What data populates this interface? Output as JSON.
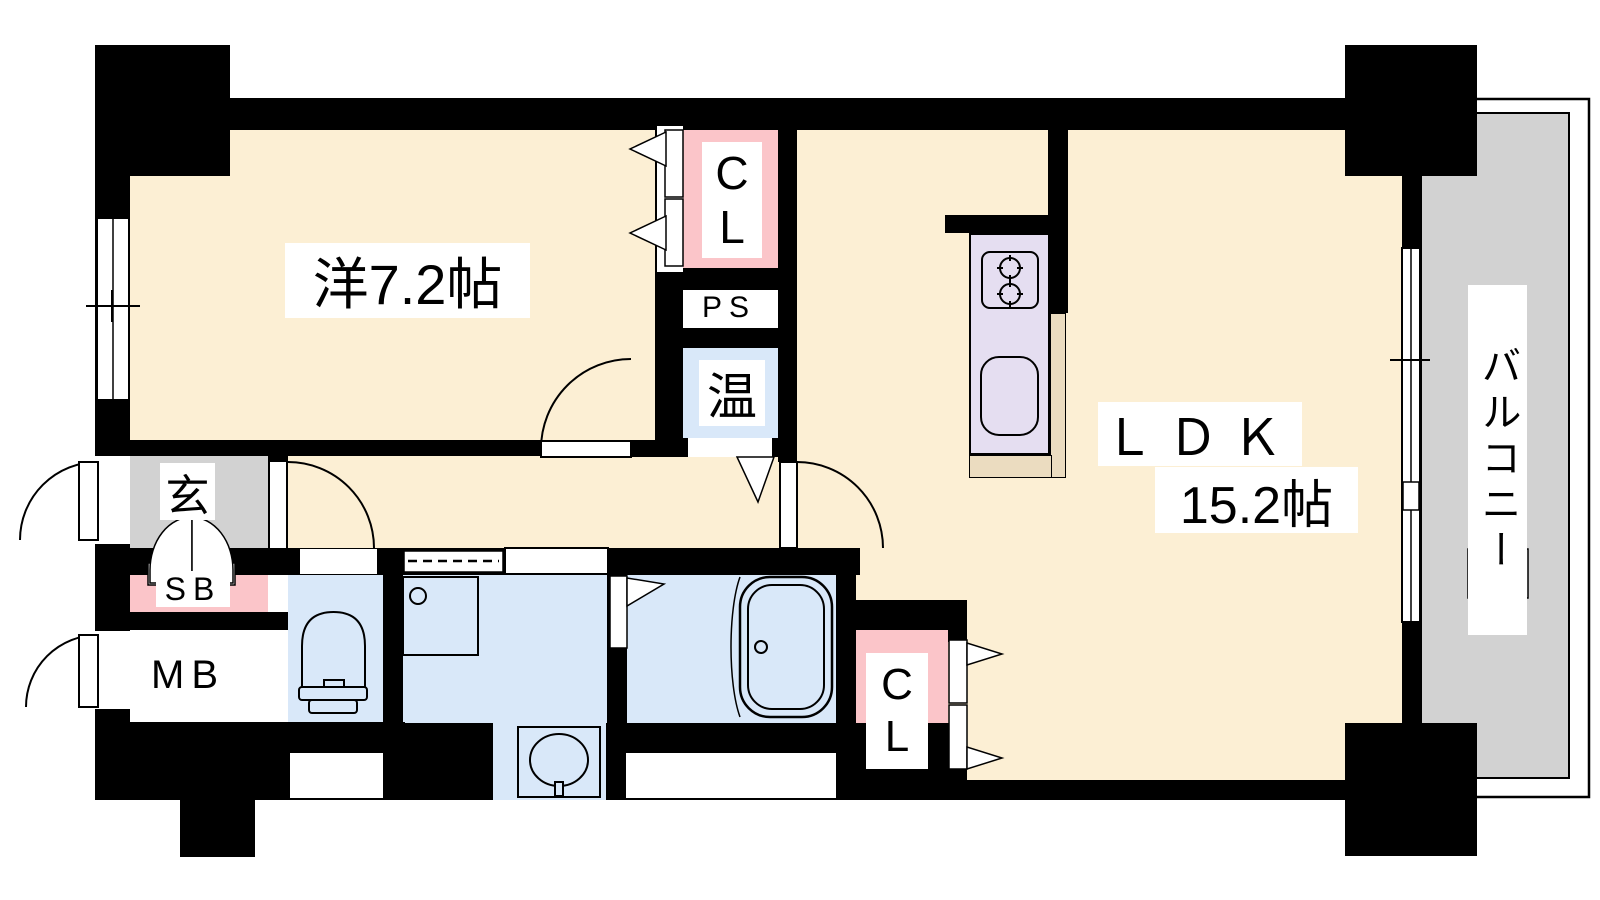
{
  "plan": {
    "western_room": {
      "label": "洋7.2帖"
    },
    "ldk": {
      "name": "ＬＤＫ",
      "size": "15.2帖"
    },
    "balcony": {
      "label": "バルコニー"
    },
    "closet_upper": {
      "label": "CL"
    },
    "closet_lower": {
      "label": "CL"
    },
    "pipe_space": {
      "label": "PS"
    },
    "water_heater": {
      "label": "温"
    },
    "entrance": {
      "label": "玄"
    },
    "shoe_box": {
      "label": "SB"
    },
    "meter_box": {
      "label": "MB"
    }
  },
  "colors": {
    "room_cream": "#FCEFD4",
    "wet_blue": "#D9E8F9",
    "closet_pink": "#FBC5C9",
    "kitchen_lavender": "#E5DEF1",
    "counter_tan": "#EBDCC0",
    "hall_gray": "#D2D2D2",
    "wall_black": "#000000"
  }
}
